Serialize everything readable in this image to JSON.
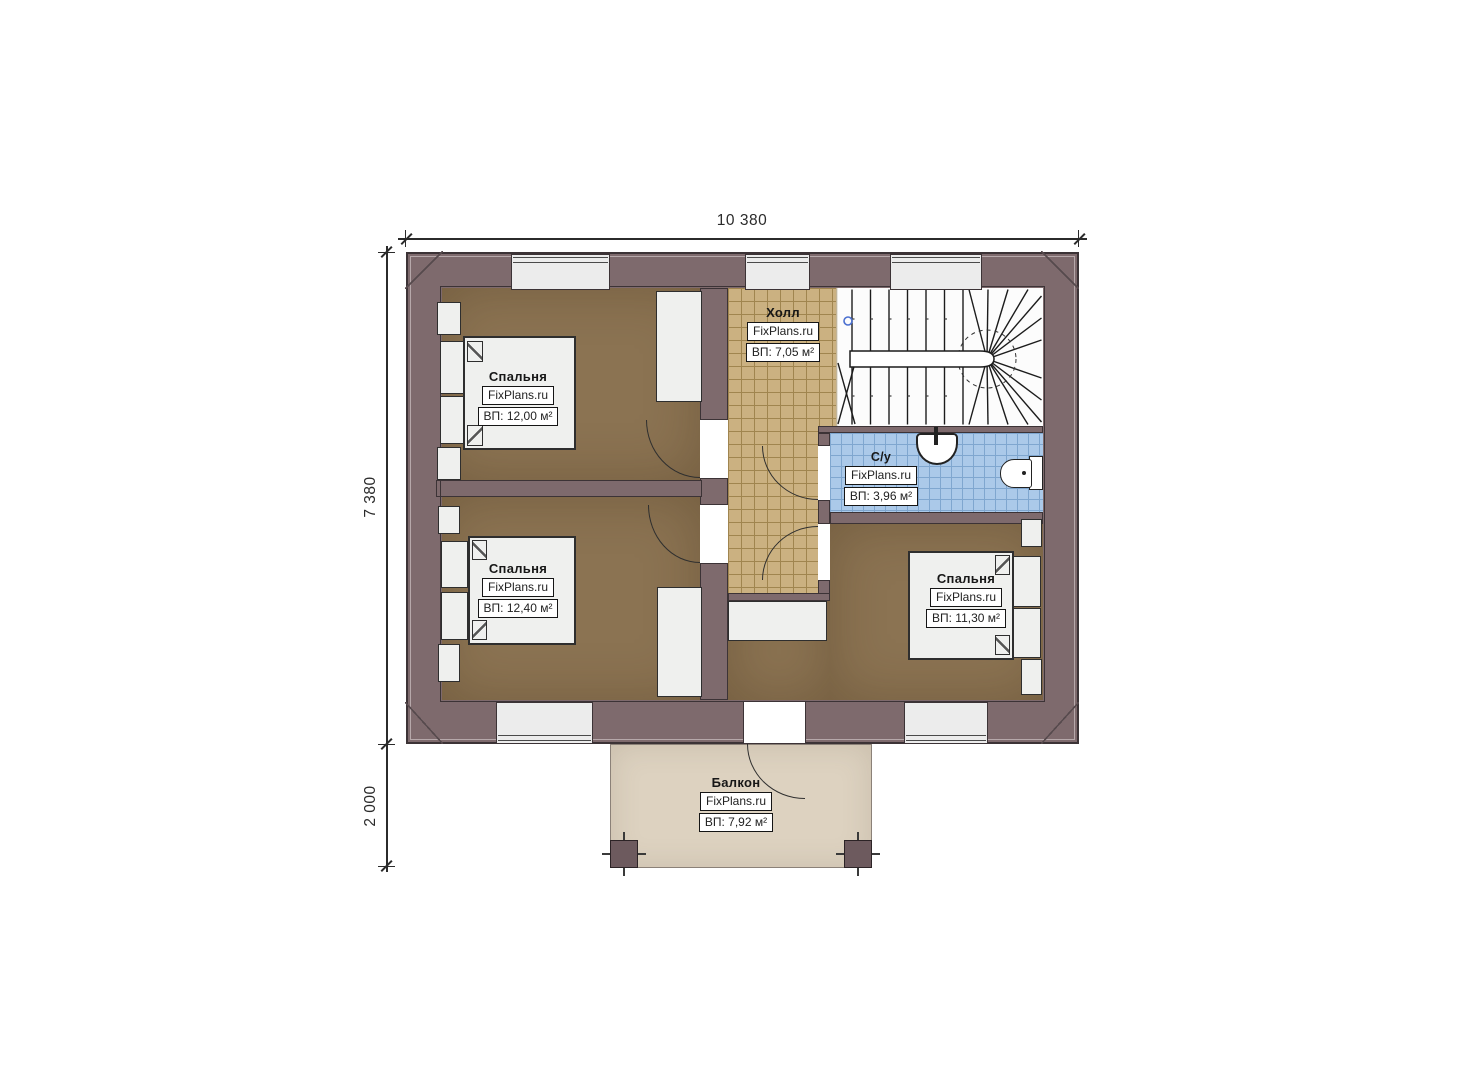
{
  "dimensions": {
    "width_top": "10 380",
    "height_left": "7 380",
    "balcony_left": "2 000"
  },
  "rooms": {
    "bedroom_tl": {
      "name": "Спальня",
      "brand": "FixPlans.ru",
      "area": "ВП: 12,00 м²"
    },
    "bedroom_bl": {
      "name": "Спальня",
      "brand": "FixPlans.ru",
      "area": "ВП: 12,40 м²"
    },
    "bedroom_br": {
      "name": "Спальня",
      "brand": "FixPlans.ru",
      "area": "ВП: 11,30 м²"
    },
    "hall": {
      "name": "Холл",
      "brand": "FixPlans.ru",
      "area": "ВП: 7,05 м²"
    },
    "bathroom": {
      "name": "С/у",
      "brand": "FixPlans.ru",
      "area": "ВП: 3,96 м²"
    },
    "balcony": {
      "name": "Балкон",
      "brand": "FixPlans.ru",
      "area": "ВП: 7,92 м²"
    }
  },
  "colors": {
    "wall": "#7e6a6d",
    "wallLine": "#3c3336",
    "floorBedroom": "#8b7352",
    "hallTile": "#cbb181",
    "hallGrout": "#a0854f",
    "bathTile": "#abc9e9",
    "bathGrout": "#7fa6cf",
    "balconyFloor": "#ddd2c0",
    "furniture": "#eff0ee",
    "outline": "#2e2e2e",
    "stairBg": "#fcfcfc",
    "dim": "#2b2b2b",
    "windowFill": "#ececec",
    "stairMarker": "#4a6fd0"
  }
}
